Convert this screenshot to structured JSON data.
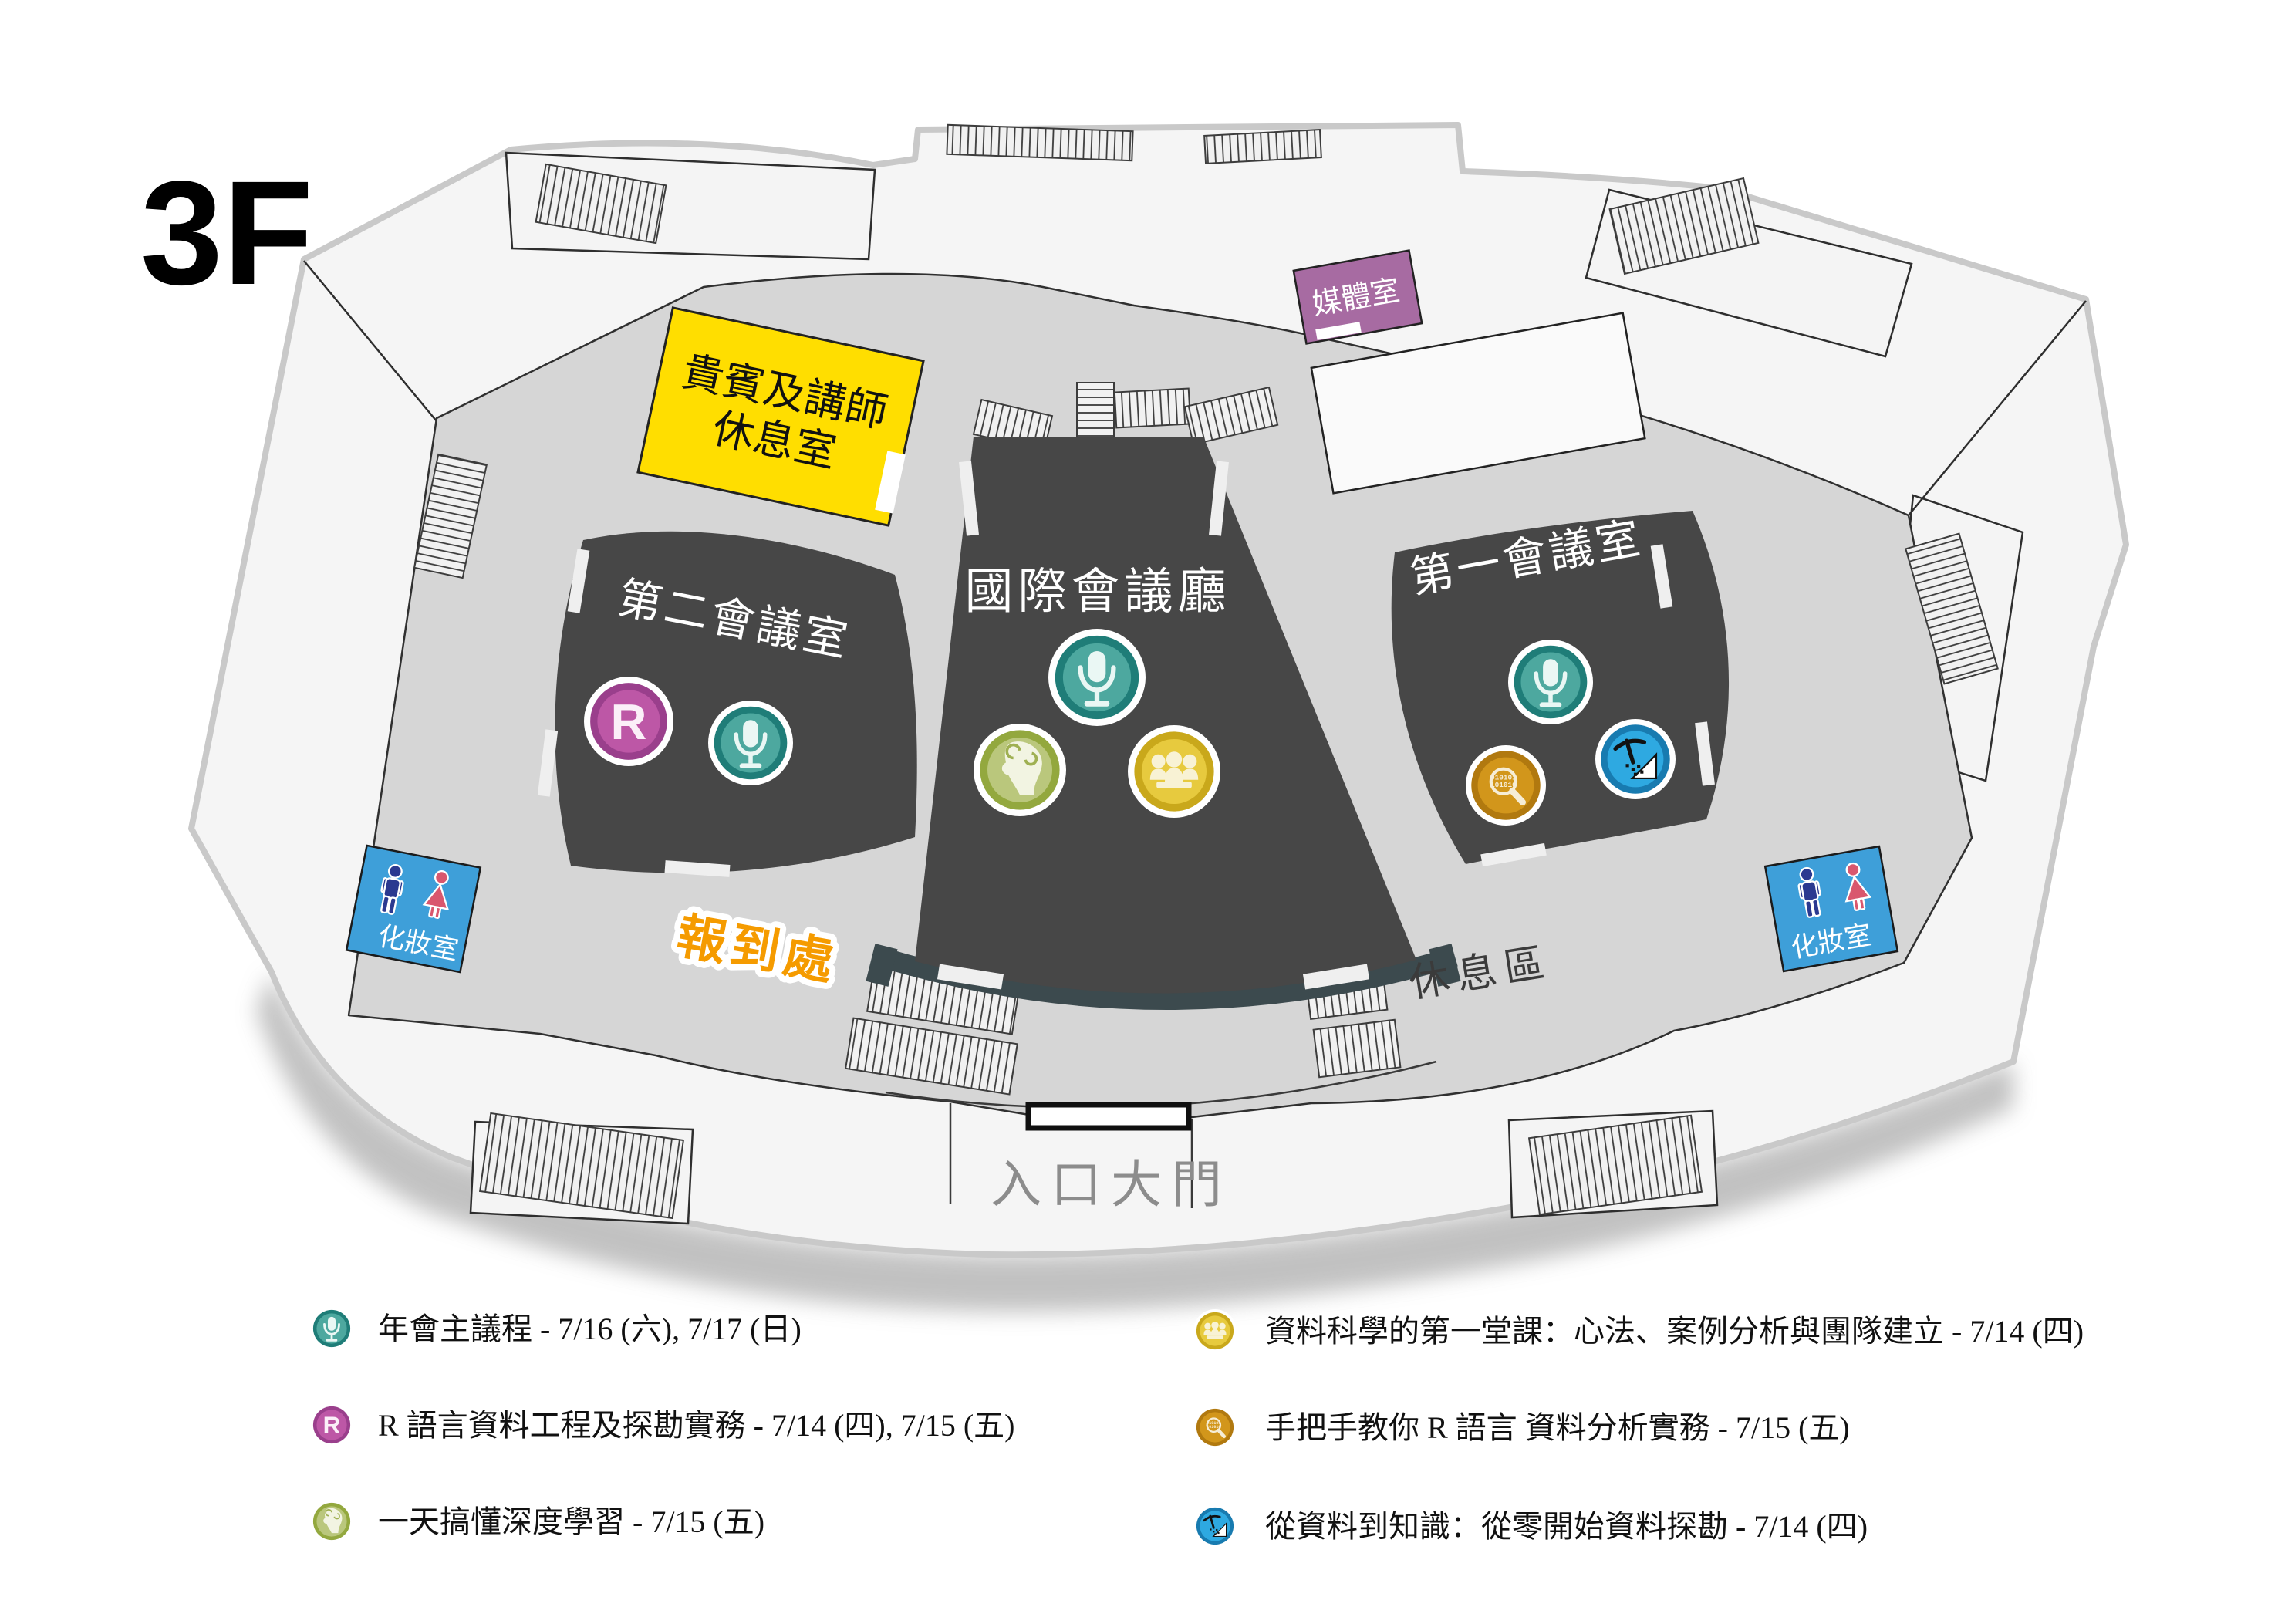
{
  "title": "3F",
  "map": {
    "rooms": {
      "vip": {
        "line1": "貴賓及講師",
        "line2": "休息室"
      },
      "room2": {
        "label": "第二會議室"
      },
      "hall": {
        "label": "國際會議廳"
      },
      "room1": {
        "label": "第一會議室"
      },
      "media": {
        "label": "媒體室"
      },
      "restroom": {
        "label": "化妝室"
      }
    },
    "labels": {
      "registration": "報到處",
      "rest_area": "休息區",
      "entrance": "入口大門"
    }
  },
  "icons": {
    "r_letter": "R",
    "binary1": "010101",
    "binary2": "101010"
  },
  "legend": {
    "left": [
      {
        "icon": "mic",
        "text": "年會主議程 - 7/16 (六), 7/17 (日)"
      },
      {
        "icon": "r-lang",
        "text": "R 語言資料工程及探勘實務 - 7/14 (四), 7/15 (五)"
      },
      {
        "icon": "brain",
        "text": "一天搞懂深度學習 - 7/15 (五)"
      }
    ],
    "right": [
      {
        "icon": "people",
        "text": "資料科學的第一堂課：心法、案例分析與團隊建立 - 7/14 (四)"
      },
      {
        "icon": "magnifier",
        "text": "手把手教你 R 語言 資料分析實務 - 7/15 (五)"
      },
      {
        "icon": "mining",
        "text": "從資料到知識：從零開始資料探勘 - 7/14 (四)"
      }
    ]
  },
  "colors": {
    "rooms": {
      "dark": "#474747",
      "vip_yellow": "#FFDE00",
      "media_purple": "#A76BA2",
      "restroom_blue": "#3E9FD9",
      "outer_floor": "#F5F5F5",
      "corridor": "#D6D6D6"
    },
    "accents": {
      "registration": "#F59B00",
      "rest_area_text": "#3B3B3B",
      "entrance_text": "#8C8C8C"
    },
    "restroom": {
      "male": "#2B3990",
      "female": "#D9576E"
    },
    "icons": {
      "mic": {
        "ring": "#1F7D78",
        "fill": "#4DA89F"
      },
      "r": {
        "ring": "#9A3F8C",
        "fill": "#BD57A6"
      },
      "brain": {
        "ring": "#93A83E",
        "fill": "#BAC77C"
      },
      "people": {
        "ring": "#C9A81B",
        "fill": "#E7CA3E"
      },
      "magnifier": {
        "ring": "#B1790F",
        "fill": "#D2961B"
      },
      "mining": {
        "ring": "#187BB0",
        "fill": "#2EA9E1"
      }
    }
  }
}
